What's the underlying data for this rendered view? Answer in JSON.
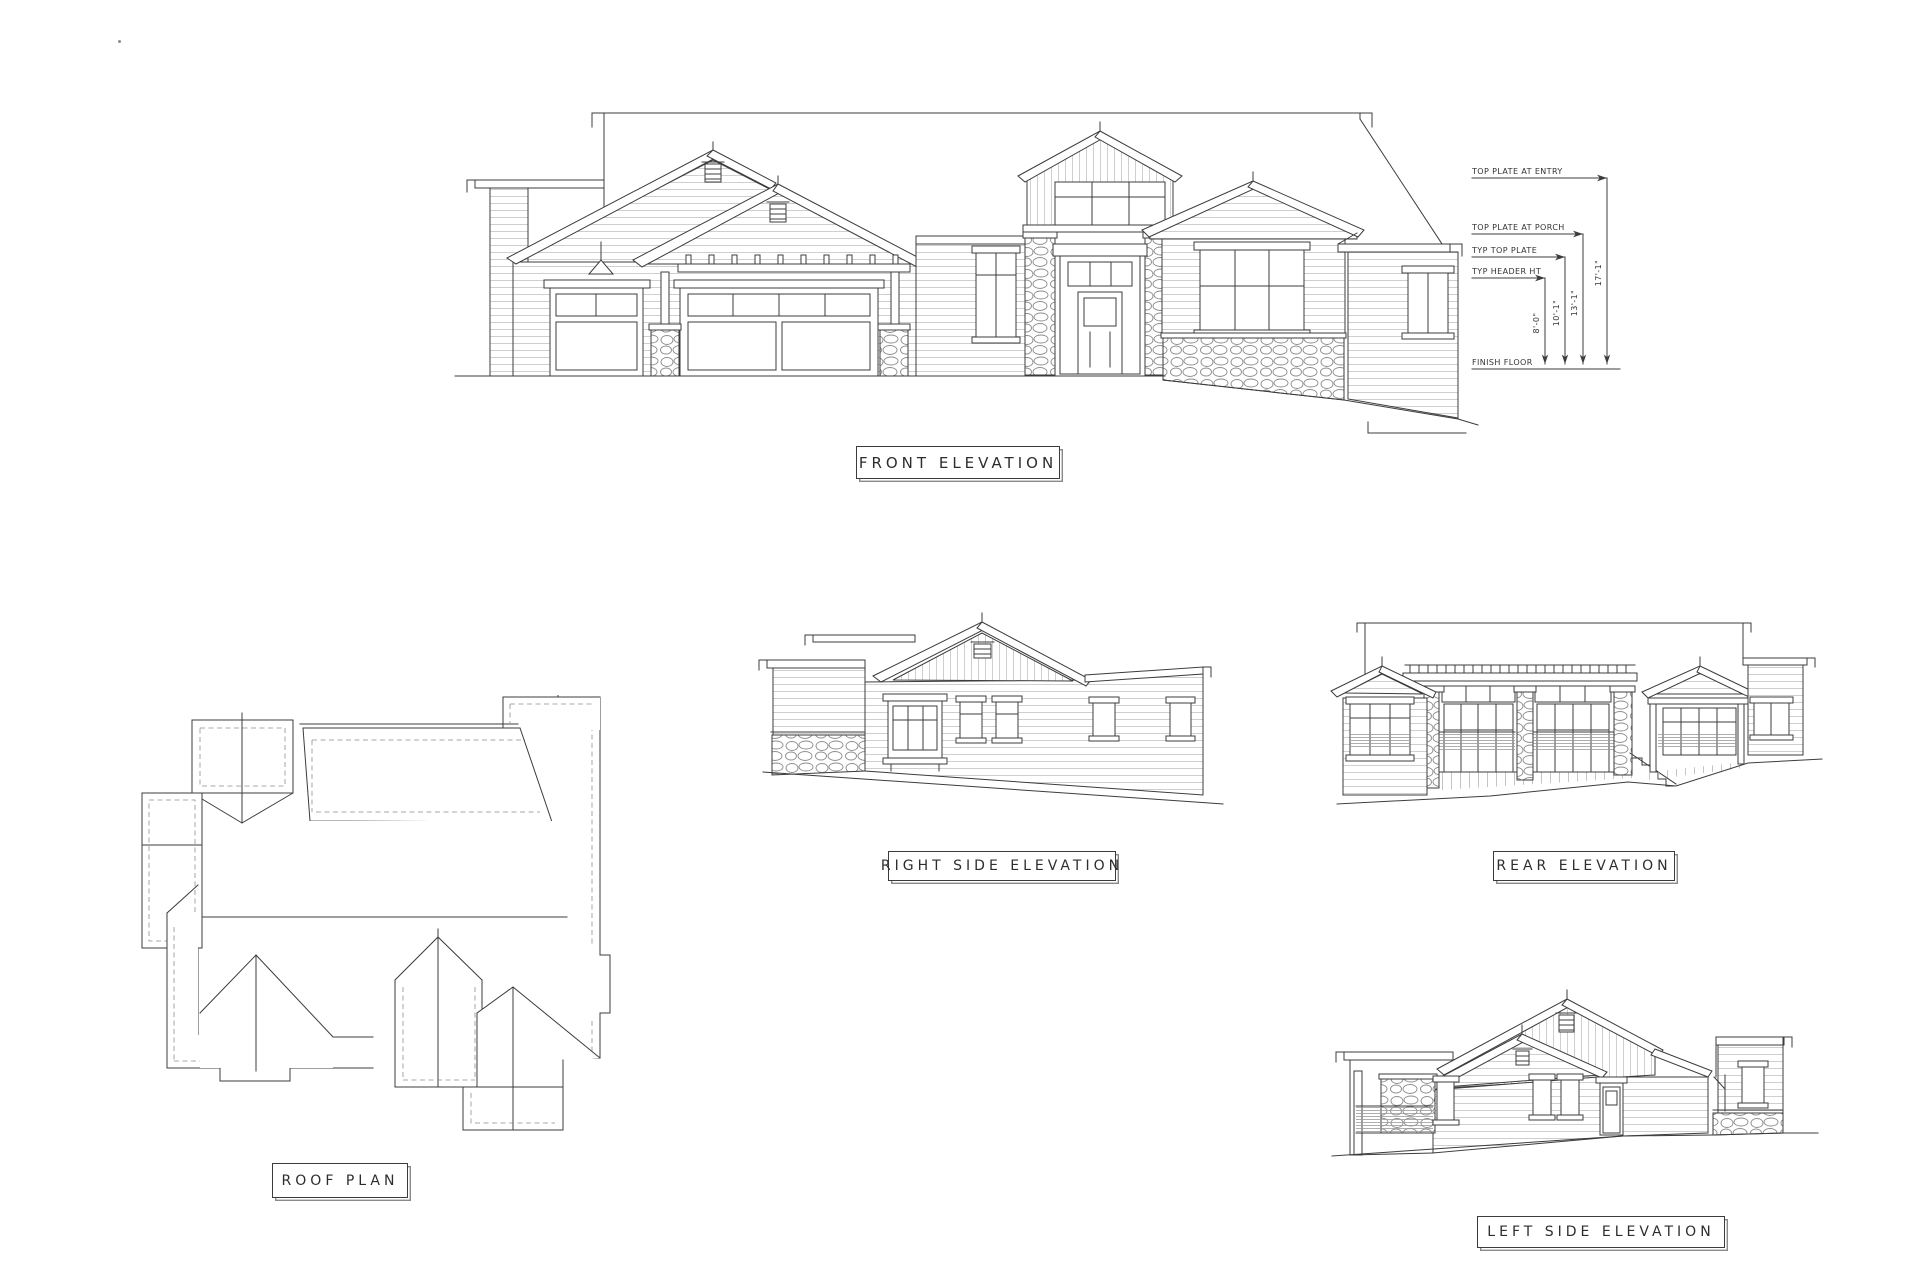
{
  "sheet": {
    "titles": {
      "front": "FRONT ELEVATION",
      "roof": "ROOF PLAN",
      "right": "RIGHT SIDE ELEVATION",
      "rear": "REAR ELEVATION",
      "left": "LEFT SIDE ELEVATION"
    },
    "front_dimensions": {
      "callouts": [
        {
          "label": "TOP PLATE AT ENTRY",
          "value": "17'-1\""
        },
        {
          "label": "TOP PLATE AT PORCH",
          "value": "13'-1\""
        },
        {
          "label": "TYP TOP PLATE",
          "value": "10'-1\""
        },
        {
          "label": "TYP HEADER HT",
          "value": "8'-0\""
        },
        {
          "label": "FINISH FLOOR",
          "value": ""
        }
      ]
    },
    "colors": {
      "ink": "#3c3c3c",
      "siding_line": "#cfcfcf",
      "stone_line": "#8b8b8b"
    }
  }
}
